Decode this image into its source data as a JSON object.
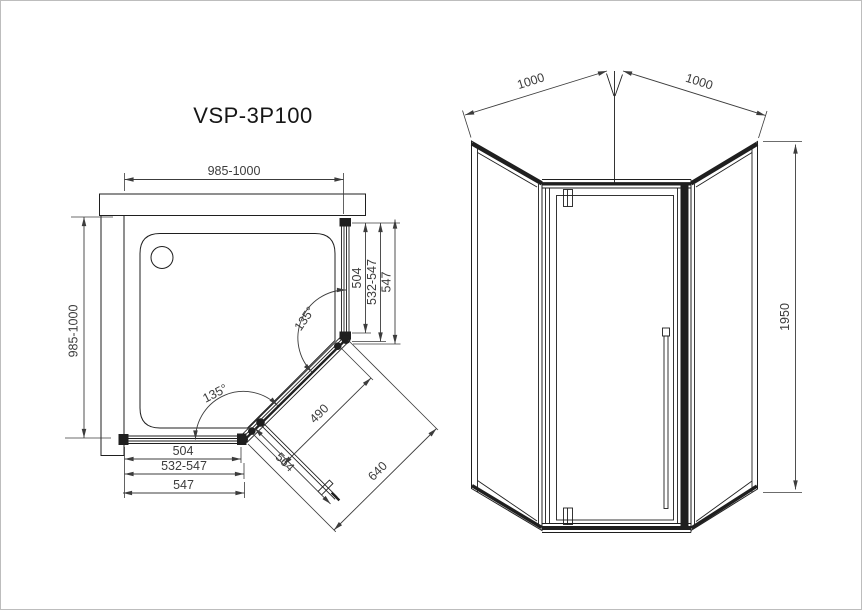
{
  "drawing": {
    "title": "VSP-3P100",
    "colors": {
      "line": "#1f1f1f",
      "dimension": "#3c3c3c",
      "background": "#ffffff",
      "page_border": "#bdbdbd"
    },
    "plan_view": {
      "dim_width_top": "985-1000",
      "dim_depth_left": "985-1000",
      "right_side": {
        "glass": "504",
        "adjust": "532-547",
        "total": "547"
      },
      "bottom_side": {
        "glass": "504",
        "adjust": "532-547",
        "total": "547"
      },
      "door": {
        "opening": "490",
        "panel": "564",
        "front_total": "640"
      },
      "angles": {
        "right": "135°",
        "bottom": "135°"
      }
    },
    "front_view": {
      "dim_width_left": "1000",
      "dim_width_right": "1000",
      "dim_height": "1950"
    }
  }
}
